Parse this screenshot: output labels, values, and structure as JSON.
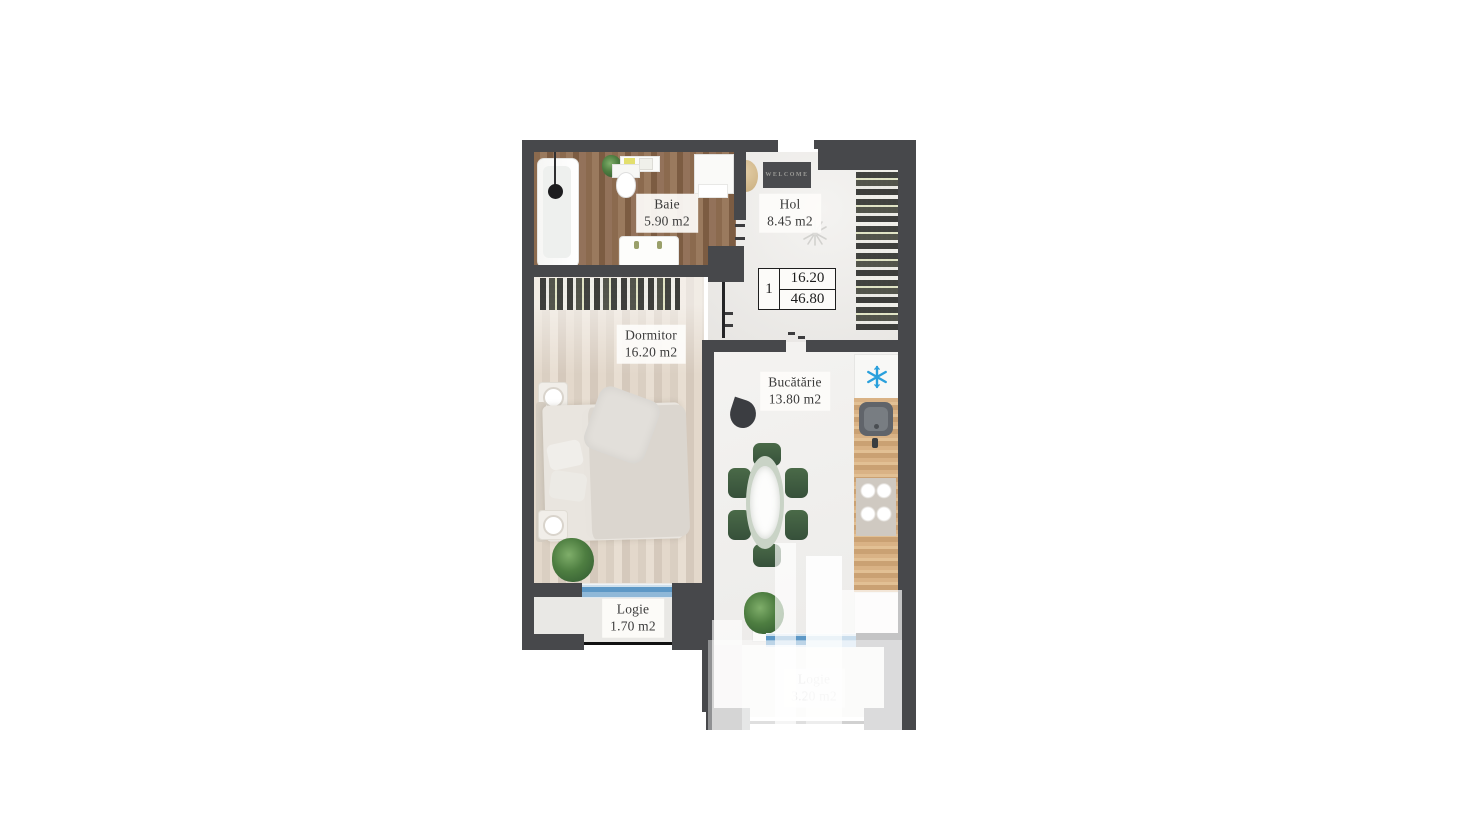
{
  "floor_plan": {
    "rooms": {
      "baie": {
        "name": "Baie",
        "area": "5.90 m2"
      },
      "hol": {
        "name": "Hol",
        "area": "8.45 m2"
      },
      "dormitor": {
        "name": "Dormitor",
        "area": "16.20 m2"
      },
      "bucatarie": {
        "name": "Bucătărie",
        "area": "13.80 m2"
      },
      "logie_1": {
        "name": "Logie",
        "area": "1.70 m2"
      },
      "logie_2": {
        "name": "Logie",
        "area": "3.20 m2"
      }
    },
    "info_box": {
      "unit_number": "1",
      "living_area": "16.20",
      "total_area": "46.80"
    },
    "entrance_mat_text": "WELCOME",
    "icons": {
      "fridge": "snowflake-icon",
      "hol_ceiling": "ceiling-light-sketch-icon"
    },
    "colors": {
      "wall": "#47484b",
      "window_glass": "#4e8fc0",
      "fridge_icon_blue": "#2aa0dc",
      "dining_chair_green": "#41603f",
      "bath_floor_wood": "#8f6f53",
      "bedroom_floor": "#ded3c7",
      "railing": "#111111"
    }
  }
}
